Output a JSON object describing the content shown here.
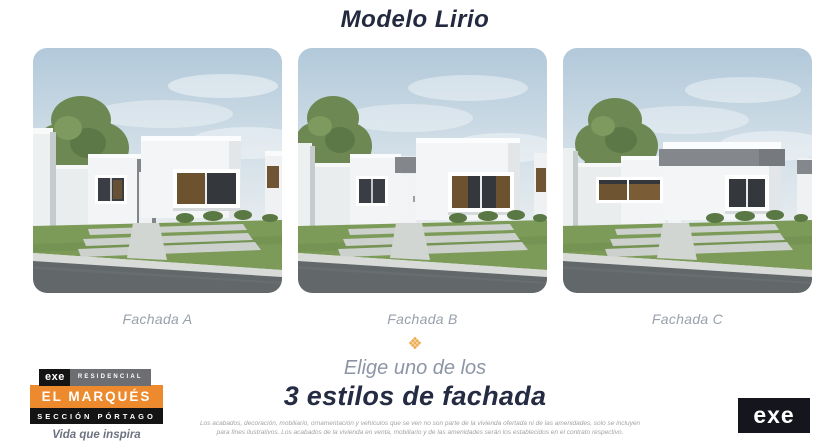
{
  "title": "Modelo Lirio",
  "facades": [
    {
      "label": "Fachada A"
    },
    {
      "label": "Fachada B"
    },
    {
      "label": "Fachada C"
    }
  ],
  "cta": {
    "line1": "Elige uno de los",
    "line2": "3 estilos de fachada"
  },
  "brand": {
    "exe": "exe",
    "residencial": "RESIDENCIAL",
    "name": "EL MARQUÉS",
    "section": "SECCIÓN PÓRTAGO",
    "tagline": "Vida que inspira"
  },
  "disclaimer": {
    "line1": "Los acabados, decoración, mobiliario, ornamentación y vehículos que se ven no son parte de la vivienda ofertada ni de las amenidades, solo se incluyen",
    "line2": "para fines ilustrativos. Los acabados de la vivienda en venta, mobiliario y de las amenidades serán los establecidos en el contrato respectivo."
  },
  "logo_right": {
    "exe": "exe"
  },
  "colors": {
    "accent_orange": "#EC8A2D",
    "diamond_orange": "#ECA94B",
    "dark_navy": "#232A40",
    "label_gray": "#99A0AC"
  }
}
